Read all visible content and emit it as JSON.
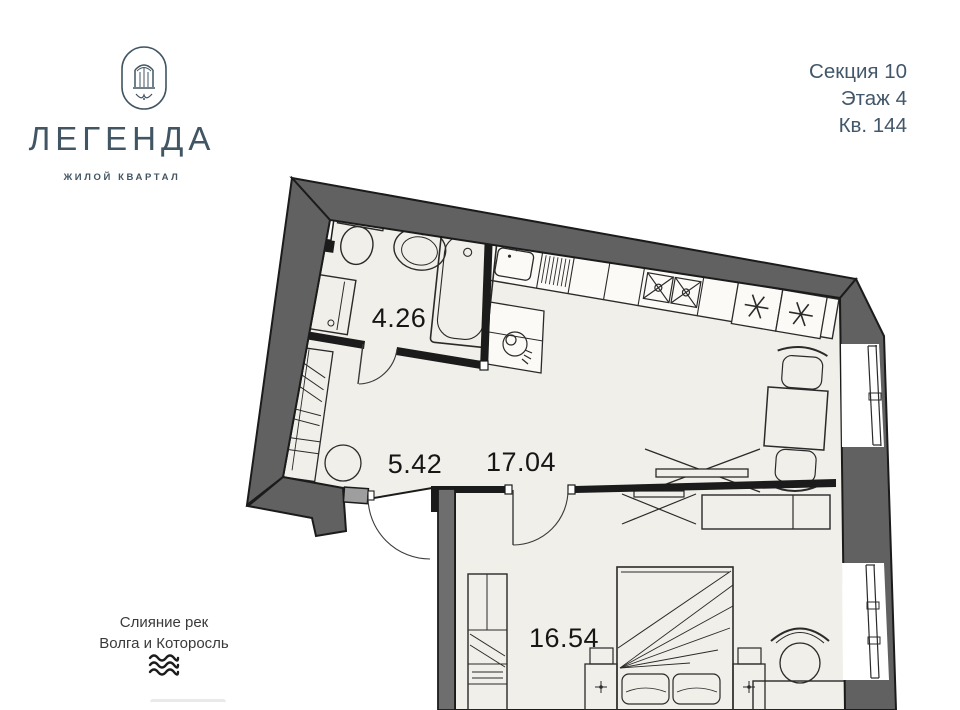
{
  "logo": {
    "name": "ЛЕГЕНДА",
    "tagline": "ЖИЛОЙ КВАРТАЛ"
  },
  "unit_info": {
    "section": "Секция 10",
    "floor": "Этаж 4",
    "apartment": "Кв. 144"
  },
  "location_note": {
    "line1": "Слияние рек",
    "line2": "Волга и Которосль"
  },
  "rooms": [
    {
      "name": "bathroom",
      "area": "4.26"
    },
    {
      "name": "hallway",
      "area": "5.42"
    },
    {
      "name": "kitchen-living",
      "area": "17.04"
    },
    {
      "name": "bedroom",
      "area": "16.54"
    }
  ],
  "icons": {
    "emblem": "arched-window-emblem",
    "location": "river-waves-icon"
  },
  "colors": {
    "brand_slate": "#42576a",
    "wall_gray": "#616161",
    "wall_black": "#1b1b1b",
    "floor_beige": "#f1efe9",
    "caption_gray": "#3a3a3a"
  }
}
